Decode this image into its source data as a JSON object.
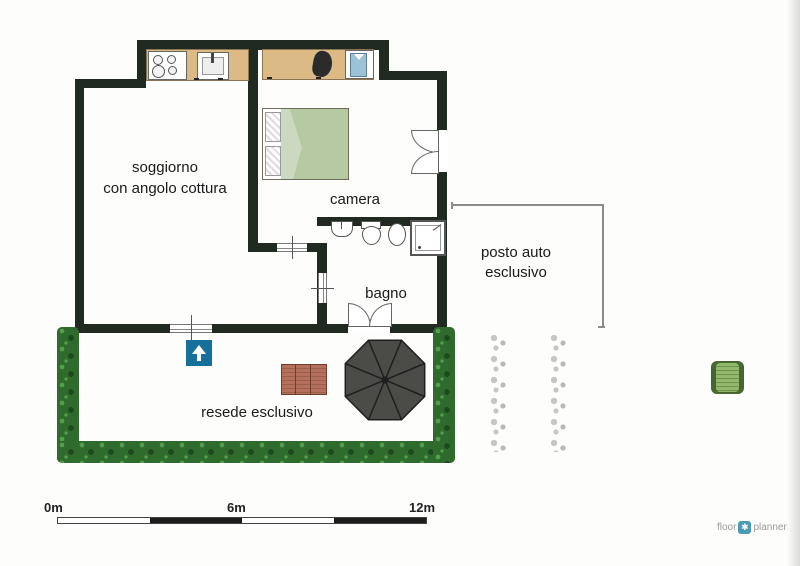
{
  "rooms": {
    "living": {
      "line1": "soggiorno",
      "line2": "con angolo cottura"
    },
    "bedroom": {
      "label": "camera"
    },
    "bathroom": {
      "label": "bagno"
    },
    "carport": {
      "line1": "posto auto",
      "line2": "esclusivo"
    },
    "yard": {
      "label": "resede esclusivo"
    }
  },
  "scale_bar": {
    "tick0": "0m",
    "tick6": "6m",
    "tick12": "12m"
  },
  "logo": {
    "floor": "floor",
    "planner": "planner",
    "mark_glyph": "✱"
  },
  "icons": {
    "entrance_arrow": "up-arrow",
    "logo_mark": "pinwheel",
    "furniture": [
      "stove",
      "kitchen-sink",
      "desk-chair",
      "wardrobe-shirt",
      "double-bed",
      "washbasin",
      "toilet",
      "bidet",
      "shower",
      "garden-table",
      "parasol",
      "armchair"
    ]
  },
  "colors": {
    "wall": "#212a20",
    "hedge_base": "#2f6b2d",
    "hedge_light": "#55a04e",
    "hedge_dark": "#1d4a1c",
    "counter_wood": "#dcba85",
    "bed_blanket": "#b7c9a2",
    "bed_fold": "#cdd8c0",
    "chair_black": "#2b2b2b",
    "shirt_blue": "#9cc2d8",
    "table_wood": "#b4705a",
    "parasol": "#4b4b47",
    "parasol_rib": "#1f1f1f",
    "arrow_bg": "#17709a",
    "armchair_green": "#8fba68",
    "armchair_border": "#47662f",
    "shrub_gray": "#c6c6c6",
    "boundary_gray": "#8c8c8c",
    "scale_dark": "#1c1c1c",
    "logo_gray": "#9b9b9b",
    "logo_blue": "#4a9bb5",
    "label": "#1a1a1a"
  }
}
